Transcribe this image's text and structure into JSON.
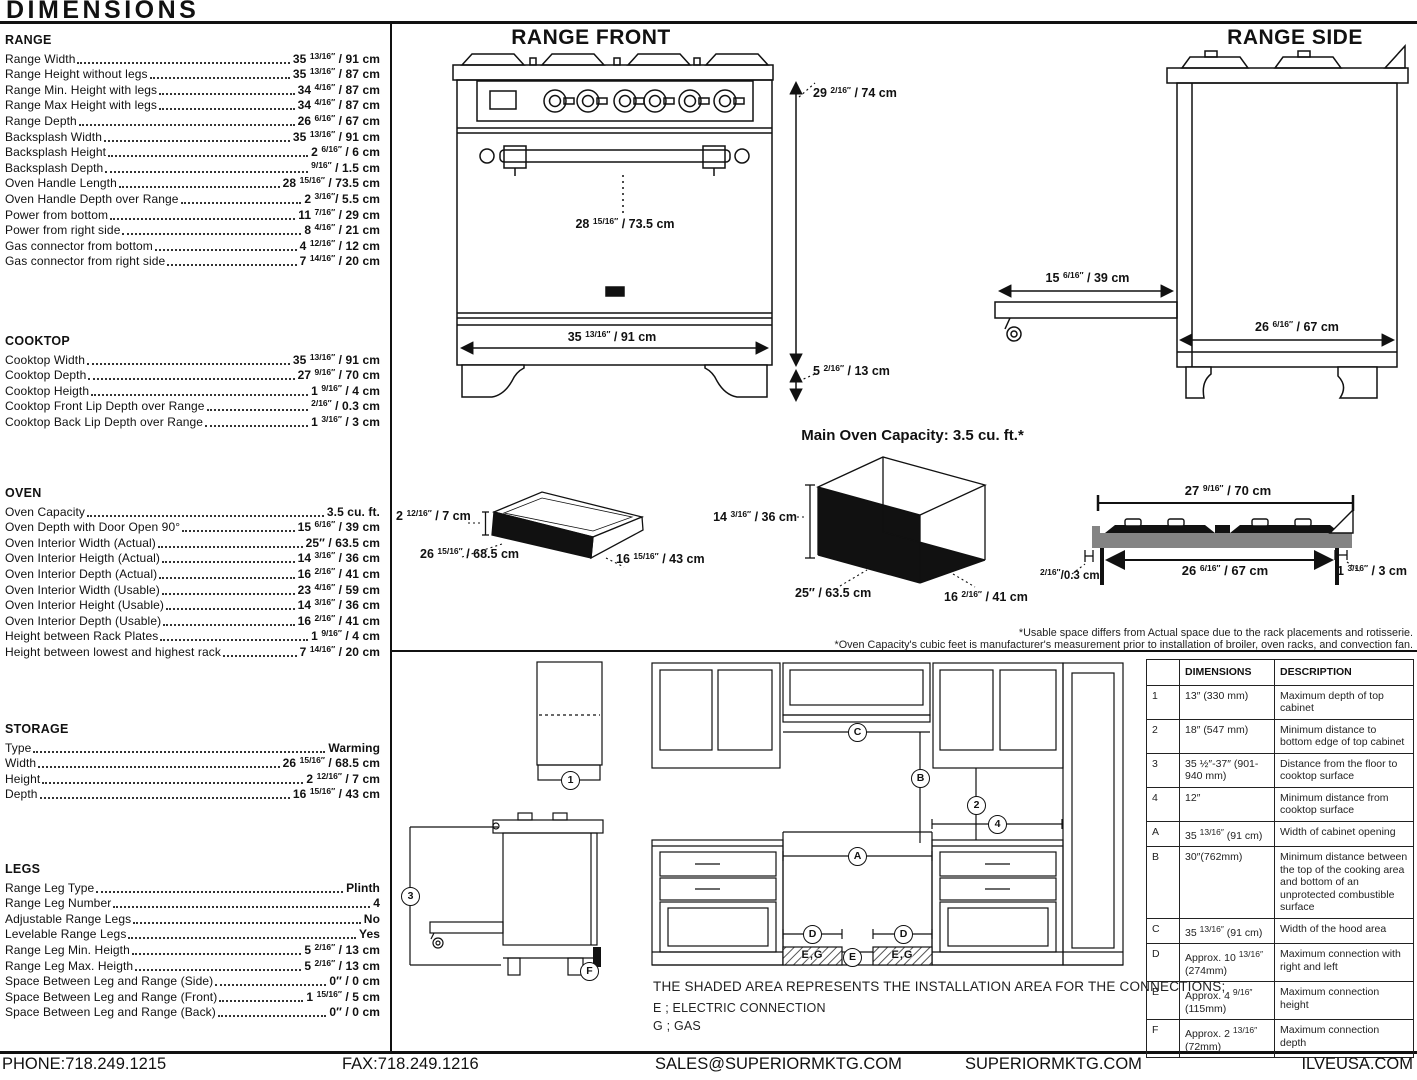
{
  "page": {
    "title": "DIMENSIONS",
    "footer": {
      "phone": "PHONE:718.249.1215",
      "fax": "FAX:718.249.1216",
      "email": "SALES@SUPERIORMKTG.COM",
      "website": "SUPERIORMKTG.COM",
      "brand_site": "ILVEUSA.COM"
    }
  },
  "specs": {
    "range": {
      "title": "RANGE",
      "items": [
        {
          "label": "Range Width",
          "value": "35 13/16\" / 91 cm"
        },
        {
          "label": "Range Height without legs",
          "value": "35 13/16\" / 87 cm"
        },
        {
          "label": "Range Min. Height with legs",
          "value": "34 4/16\" / 87 cm"
        },
        {
          "label": "Range Max Height with legs",
          "value": "34 4/16\" / 87 cm"
        },
        {
          "label": "Range Depth",
          "value": "26 6/16\" / 67 cm"
        },
        {
          "label": "Backsplash Width",
          "value": "35 13/16\" / 91 cm"
        },
        {
          "label": "Backsplash Height",
          "value": "2 6/16\" / 6 cm"
        },
        {
          "label": "Backsplash Depth",
          "value": "9/16\" / 1.5 cm"
        },
        {
          "label": "Oven Handle Length",
          "value": "28 15/16\" / 73.5 cm"
        },
        {
          "label": "Oven Handle Depth over Range",
          "value": "2 3/16\"/ 5.5 cm"
        },
        {
          "label": "Power from bottom",
          "value": "11 7/16\" / 29 cm"
        },
        {
          "label": "Power from right side",
          "value": "8 4/16\" / 21 cm"
        },
        {
          "label": "Gas connector from bottom",
          "value": "4 12/16\" / 12 cm"
        },
        {
          "label": "Gas connector from right side",
          "value": "7 14/16\" / 20 cm"
        }
      ]
    },
    "cooktop": {
      "title": "COOKTOP",
      "items": [
        {
          "label": "Cooktop Width",
          "value": "35 13/16\" / 91 cm"
        },
        {
          "label": "Cooktop Depth",
          "value": "27 9/16\" / 70 cm"
        },
        {
          "label": "Cooktop Heigth",
          "value": "1 9/16\" / 4 cm"
        },
        {
          "label": "Cooktop Front Lip Depth over Range",
          "value": "2/16\" / 0.3 cm"
        },
        {
          "label": "Cooktop Back Lip Depth over Range",
          "value": "1 3/16\" / 3 cm"
        }
      ]
    },
    "oven": {
      "title": "OVEN",
      "items": [
        {
          "label": "Oven Capacity",
          "value": "3.5 cu. ft."
        },
        {
          "label": "Oven Depth with Door Open 90°",
          "value": "15 6/16\" / 39 cm"
        },
        {
          "label": "Oven Interior Width (Actual)",
          "value": "25\" / 63.5 cm"
        },
        {
          "label": "Oven Interior Heigth (Actual)",
          "value": "14 3/16\" / 36 cm"
        },
        {
          "label": "Oven Interior Depth (Actual)",
          "value": "16 2/16\" / 41 cm"
        },
        {
          "label": "Oven Interior Width (Usable)",
          "value": "23 4/16\" / 59 cm"
        },
        {
          "label": "Oven Interior Height (Usable)",
          "value": "14 3/16\" / 36 cm"
        },
        {
          "label": "Oven Interior Depth (Usable)",
          "value": "16 2/16\" / 41 cm"
        },
        {
          "label": "Height between Rack Plates",
          "value": "1 9/16\" / 4 cm"
        },
        {
          "label": "Height between lowest and highest rack",
          "value": "7 14/16\" / 20 cm"
        }
      ]
    },
    "storage": {
      "title": "STORAGE",
      "items": [
        {
          "label": "Type",
          "value": "Warming"
        },
        {
          "label": "Width",
          "value": "26 15/16\" / 68.5 cm"
        },
        {
          "label": "Height",
          "value": "2 12/16\" / 7 cm"
        },
        {
          "label": "Depth",
          "value": "16 15/16\" / 43 cm"
        }
      ]
    },
    "legs": {
      "title": "LEGS",
      "items": [
        {
          "label": "Range Leg Type",
          "value": "Plinth"
        },
        {
          "label": "Range Leg Number",
          "value": "4"
        },
        {
          "label": "Adjustable Range Legs",
          "value": "No"
        },
        {
          "label": "Levelable Range Legs",
          "value": "Yes"
        },
        {
          "label": "Range Leg Min. Heigth",
          "value": "5 2/16\" / 13 cm"
        },
        {
          "label": "Range Leg Max. Heigth",
          "value": "5 2/16\" / 13 cm"
        },
        {
          "label": "Space Between Leg and Range (Side)",
          "value": "0\" / 0 cm"
        },
        {
          "label": "Space Between Leg and Range (Front)",
          "value": "1 15/16\" / 5 cm"
        },
        {
          "label": "Space Between Leg and Range (Back)",
          "value": "0\" / 0 cm"
        }
      ]
    }
  },
  "diagrams": {
    "front": {
      "title": "RANGE FRONT",
      "overall_height": "29 2/16\" / 74 cm",
      "handle_length": "28 15/16\" / 73.5 cm",
      "width": "35 13/16\" / 91 cm",
      "leg_height": "5 2/16\" / 13 cm"
    },
    "side": {
      "title": "RANGE SIDE",
      "door_open": "15 6/16\" / 39 cm",
      "depth": "26 6/16\" / 67 cm"
    },
    "drawer": {
      "height": "2 12/16\" / 7 cm",
      "width": "26 15/16\" / 68.5 cm",
      "depth": "16 15/16\" / 43 cm"
    },
    "oven_box": {
      "title": "Main Oven Capacity: 3.5 cu. ft.*",
      "height": "14 3/16\" / 36 cm",
      "width": "25\" / 63.5 cm",
      "depth": "16 2/16\" / 41 cm"
    },
    "cooktop_profile": {
      "top_width": "27 9/16\" / 70 cm",
      "burner_width": "26 6/16\" / 67 cm",
      "front_lip": "2/16\"/0.3 cm",
      "back_lip": "1 3/16\" / 3 cm"
    },
    "footnotes": [
      "*Usable space differs from Actual space due to the rack placements and rotisserie.",
      "*Oven Capacity's cubic feet is manufacturer's measurement prior to installation of broiler, oven racks, and convection fan."
    ]
  },
  "installation": {
    "callouts": {
      "one": "1",
      "two": "2",
      "three": "3",
      "four": "4",
      "a": "A",
      "b": "B",
      "c": "C",
      "d": "D",
      "e": "E",
      "f": "F",
      "eg": "E,G"
    },
    "note": "THE SHADED AREA REPRESENTS THE INSTALLATION AREA FOR THE CONNECTIONS;",
    "legend_e": "E ; ELECTRIC CONNECTION",
    "legend_g": "G ; GAS",
    "table": {
      "headers": [
        "",
        "DIMENSIONS",
        "DESCRIPTION"
      ],
      "rows": [
        {
          "id": "1",
          "dimension": "13\" (330 mm)",
          "description": "Maximum depth of top cabinet"
        },
        {
          "id": "2",
          "dimension": "18\" (547 mm)",
          "description": "Minimum distance to bottom edge of top cabinet"
        },
        {
          "id": "3",
          "dimension": "35 ½\"-37\" (901-940 mm)",
          "description": "Distance from the floor to cooktop surface"
        },
        {
          "id": "4",
          "dimension": "12\"",
          "description": "Minimum distance from cooktop surface"
        },
        {
          "id": "A",
          "dimension": "35 13/16\" (91 cm)",
          "description": "Width of cabinet opening"
        },
        {
          "id": "B",
          "dimension": "30\"(762mm)",
          "description": "Minimum distance between the top of the cooking area and bottom of an unprotected combustible surface"
        },
        {
          "id": "C",
          "dimension": "35 13/16\" (91 cm)",
          "description": "Width of the hood area"
        },
        {
          "id": "D",
          "dimension": "Approx. 10 13/16\" (274mm)",
          "description": "Maximum connection with right and left"
        },
        {
          "id": "E",
          "dimension": "Approx. 4 9/16\" (115mm)",
          "description": "Maximum connection height"
        },
        {
          "id": "F",
          "dimension": "Approx. 2 13/16\" (72mm)",
          "description": "Maximum connection depth"
        }
      ]
    }
  }
}
